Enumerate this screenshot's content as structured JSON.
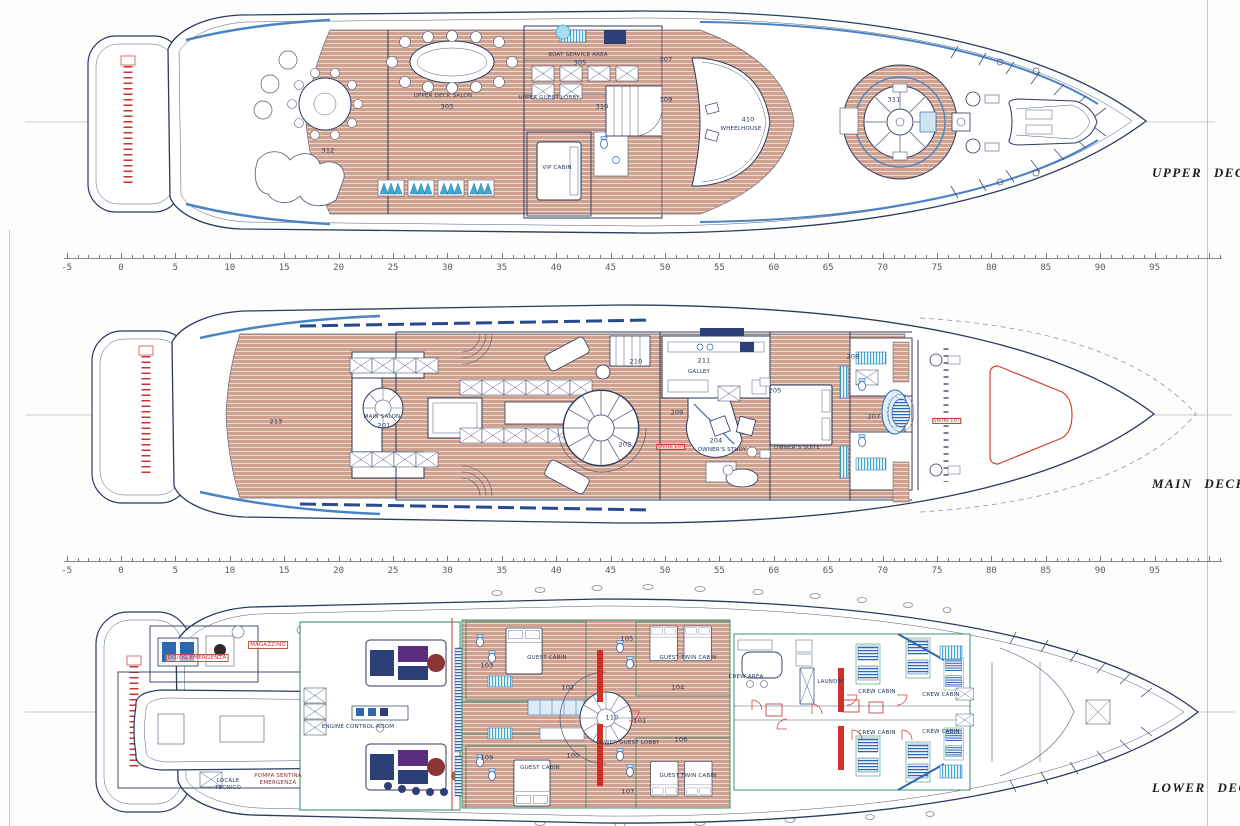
{
  "deck_names": {
    "upper": "UPPER DECK",
    "main": "MAIN DECK",
    "lower": "LOWER DECK"
  },
  "ruler": {
    "unit_min": -5,
    "unit_max": 95,
    "step": 5,
    "values": [
      "-5",
      "0",
      "5",
      "10",
      "15",
      "20",
      "25",
      "30",
      "35",
      "40",
      "45",
      "50",
      "55",
      "60",
      "65",
      "70",
      "75",
      "80",
      "85",
      "90",
      "95"
    ]
  },
  "room_labels": {
    "upper": [
      {
        "t": "312",
        "x": 328,
        "y": 151,
        "c": "num"
      },
      {
        "t": "UPPER DECK SALON",
        "x": 443,
        "y": 96
      },
      {
        "t": "303",
        "x": 447,
        "y": 107,
        "c": "num"
      },
      {
        "t": "BOAT SERVICE AREA",
        "x": 578,
        "y": 55
      },
      {
        "t": "305",
        "x": 580,
        "y": 63,
        "c": "num"
      },
      {
        "t": "UPPER GUEST LOBBY",
        "x": 549,
        "y": 98
      },
      {
        "t": "310",
        "x": 602,
        "y": 107,
        "c": "num"
      },
      {
        "t": "307",
        "x": 666,
        "y": 60,
        "c": "num"
      },
      {
        "t": "309",
        "x": 666,
        "y": 100,
        "c": "num"
      },
      {
        "t": "VIP CABIN",
        "x": 557,
        "y": 168
      },
      {
        "t": "410",
        "x": 748,
        "y": 120,
        "c": "num"
      },
      {
        "t": "WHEELHOUSE",
        "x": 741,
        "y": 129
      },
      {
        "t": "311",
        "x": 894,
        "y": 100,
        "c": "num"
      }
    ],
    "main": [
      {
        "t": "213",
        "x": 276,
        "y": 422,
        "c": "num"
      },
      {
        "t": "MAIN SALON",
        "x": 382,
        "y": 417
      },
      {
        "t": "201",
        "x": 384,
        "y": 426,
        "c": "num"
      },
      {
        "t": "209",
        "x": 677,
        "y": 413,
        "c": "num"
      },
      {
        "t": "202",
        "x": 625,
        "y": 445,
        "c": "num"
      },
      {
        "t": "SMOKE EXIT",
        "x": 671,
        "y": 447,
        "c": "redbox"
      },
      {
        "t": "210",
        "x": 636,
        "y": 362,
        "c": "num"
      },
      {
        "t": "211",
        "x": 704,
        "y": 361,
        "c": "num"
      },
      {
        "t": "GALLEY",
        "x": 699,
        "y": 372
      },
      {
        "t": "204",
        "x": 716,
        "y": 441,
        "c": "num"
      },
      {
        "t": "OWNER'S STUDY",
        "x": 722,
        "y": 450
      },
      {
        "t": "OWNER'S SUITE",
        "x": 797,
        "y": 448
      },
      {
        "t": "205",
        "x": 775,
        "y": 391,
        "c": "num"
      },
      {
        "t": "208",
        "x": 853,
        "y": 357,
        "c": "num"
      },
      {
        "t": "207",
        "x": 874,
        "y": 417,
        "c": "num"
      },
      {
        "t": "SMOKE EXIT",
        "x": 947,
        "y": 421,
        "c": "redbox"
      }
    ],
    "lower": [
      {
        "t": "MAGAZZINO",
        "x": 268,
        "y": 645,
        "c": "red"
      },
      {
        "t": "DO/OG EMERGENZA",
        "x": 197,
        "y": 658,
        "c": "red"
      },
      {
        "t": "ENGINE CONTROL ROOM",
        "x": 358,
        "y": 727
      },
      {
        "t": "POMPA SENTINA",
        "x": 278,
        "y": 776,
        "c": "dred"
      },
      {
        "t": "EMERGENZA",
        "x": 278,
        "y": 783,
        "c": "dred"
      },
      {
        "t": "LOCALE",
        "x": 228,
        "y": 781
      },
      {
        "t": "TECNICO",
        "x": 228,
        "y": 788
      },
      {
        "t": "105",
        "x": 627,
        "y": 639,
        "c": "num"
      },
      {
        "t": "GUEST CABIN",
        "x": 547,
        "y": 658
      },
      {
        "t": "103",
        "x": 487,
        "y": 666,
        "c": "num"
      },
      {
        "t": "GUEST TWIN CABIN",
        "x": 688,
        "y": 658
      },
      {
        "t": "102",
        "x": 568,
        "y": 688,
        "c": "num"
      },
      {
        "t": "104",
        "x": 678,
        "y": 688,
        "c": "num"
      },
      {
        "t": "110",
        "x": 612,
        "y": 718,
        "c": "num"
      },
      {
        "t": "101",
        "x": 640,
        "y": 721,
        "c": "num"
      },
      {
        "t": "LOWER GUEST LOBBY",
        "x": 628,
        "y": 743
      },
      {
        "t": "106",
        "x": 681,
        "y": 740,
        "c": "num"
      },
      {
        "t": "109",
        "x": 487,
        "y": 758,
        "c": "num"
      },
      {
        "t": "100",
        "x": 573,
        "y": 756,
        "c": "num"
      },
      {
        "t": "GUEST CABIN",
        "x": 540,
        "y": 768
      },
      {
        "t": "GUEST TWIN CABIN",
        "x": 688,
        "y": 776
      },
      {
        "t": "107",
        "x": 628,
        "y": 792,
        "c": "num"
      },
      {
        "t": "CREW AREA",
        "x": 746,
        "y": 677
      },
      {
        "t": "LAUNDRY",
        "x": 831,
        "y": 682
      },
      {
        "t": "CREW CABIN",
        "x": 877,
        "y": 692
      },
      {
        "t": "CREW CABIN",
        "x": 941,
        "y": 695
      },
      {
        "t": "CREW CABIN",
        "x": 877,
        "y": 733
      },
      {
        "t": "CREW CABIN",
        "x": 941,
        "y": 732
      }
    ]
  },
  "colors": {
    "teak": "#cfa190",
    "teak_line": "#eedacd",
    "outline_navy": "#2c3a5c",
    "furniture_blue": "#2f66b0",
    "accent_cyan": "#3fa8cc",
    "fire_red": "#cc3333",
    "wall_green": "#3f9070"
  }
}
